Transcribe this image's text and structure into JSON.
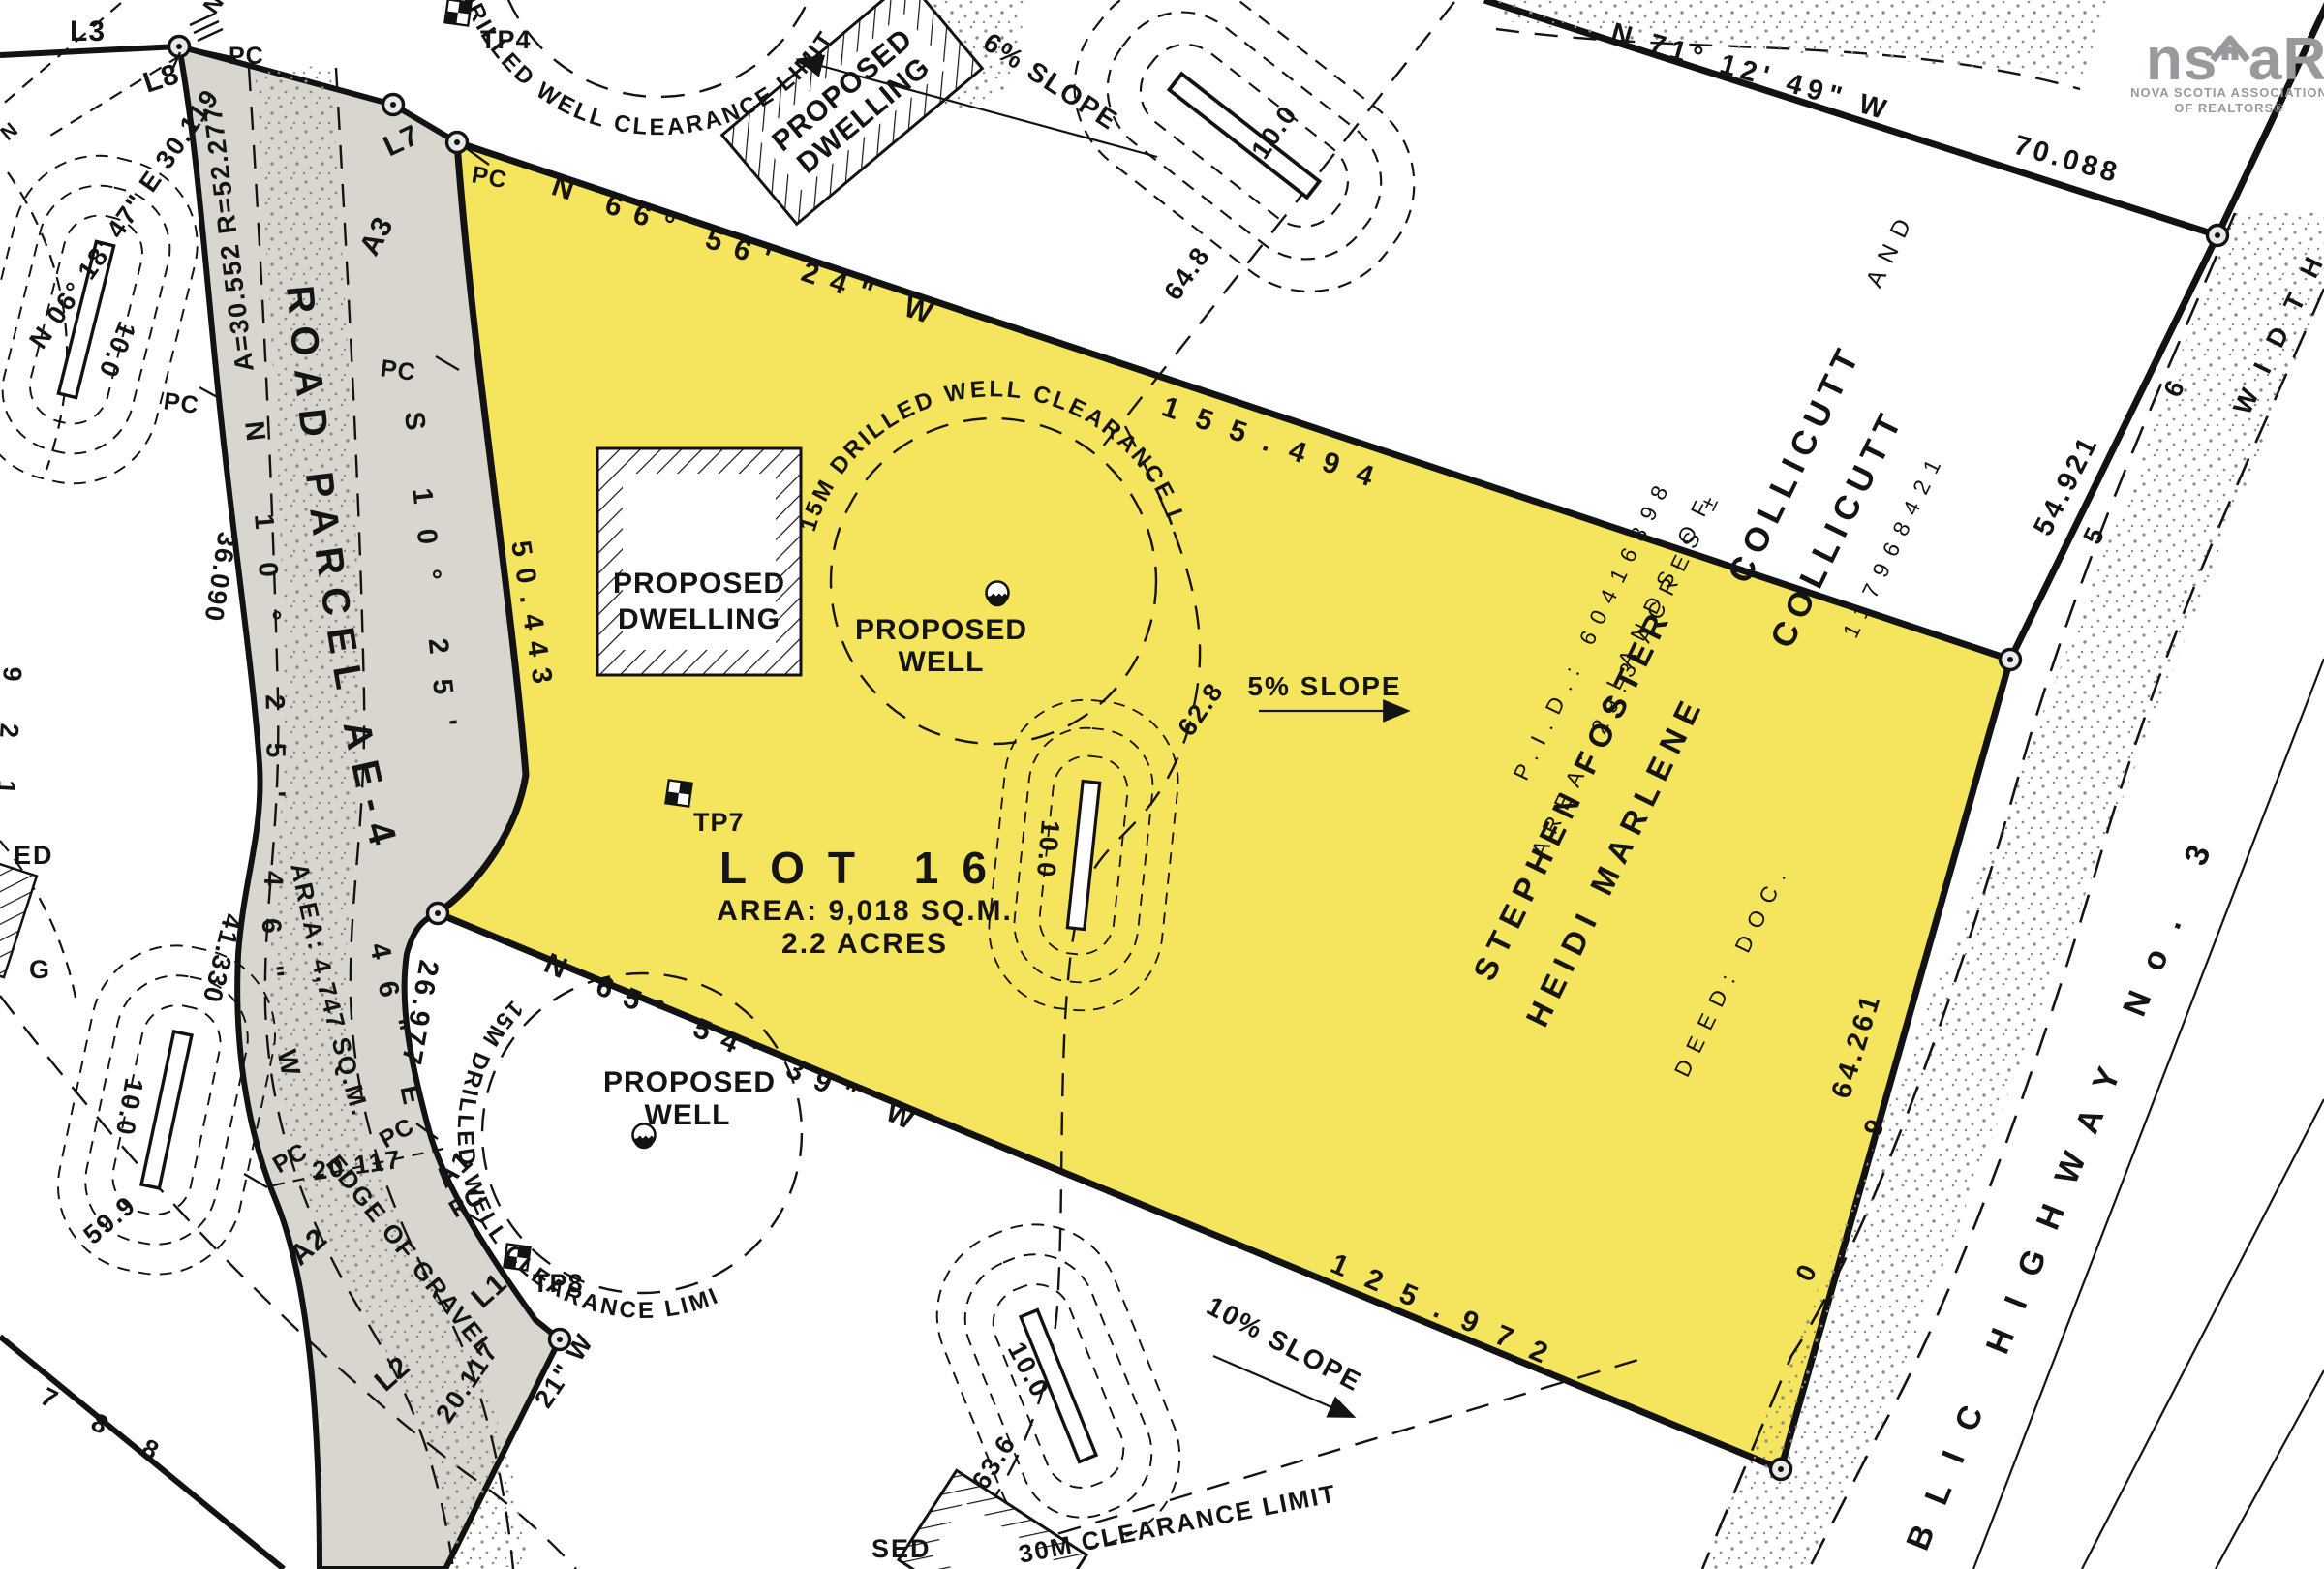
{
  "colors": {
    "lot_fill": "#F4E45E",
    "road_fill": "#D9D6CF",
    "line": "#141414",
    "logo_gray": "#97999C"
  },
  "logo": {
    "ns": "ns",
    "ar": "aR",
    "assoc": "NOVA SCOTIA ASSOCIATION",
    "realtors": "OF REALTORS®"
  },
  "lot16": {
    "name": "LOT 16",
    "area": "AREA: 9,018 SQ.M.",
    "acres": "2.2 ACRES"
  },
  "road": {
    "name": "ROAD PARCEL AE-4",
    "area": "AREA: 4,747 SQ.M.",
    "edge_of_gravel": "EDGE OF GRAVEL",
    "centerline_bearing": "N 10° 25' 46\" W",
    "curve": "A=30.552 R=52.277",
    "cross_width": "20.117"
  },
  "segments": {
    "l1": "L1",
    "l2": "L2",
    "l3": "L3",
    "l7": "L7",
    "l8": "L8",
    "a1": "A1",
    "a2": "A2",
    "a3": "A3",
    "pc": "PC"
  },
  "bearings": {
    "north": "N 66° 56' 24\" W",
    "north_d": "155.494",
    "south": "N 65° 54' 39\" W",
    "south_d": "125.972",
    "northeast": "N 71° 12' 49\" W",
    "northeast_d": "70.088",
    "highway_upper_d": "54.921",
    "highway_lower_d": "64.261",
    "west_upper": "S 10° 25'",
    "west_lower": "46\" E",
    "west_d": "50.443",
    "west_lower_d": "26.977",
    "nw": "N 06° 18' 47\" E 30.119",
    "bottom_d": "20.117",
    "bottom_frag": "21\" W"
  },
  "owner": {
    "pid": "P.I.D.: 60416898",
    "area": "AREA: 29.3 ACRES ±",
    "lands": "LANDS OF",
    "name1": "STEPHEN FOSTER",
    "name2": "HEIDI MARLENE",
    "surname": "COLLICUTT",
    "conj": "AND",
    "deed": "DEED: DOC.",
    "deed_no": "117968421"
  },
  "features": {
    "proposed": "PROPOSED",
    "dwelling": "DWELLING",
    "well": "WELL",
    "clearance15": "15M DRILLED WELL CLEARANCE LIMIT",
    "clearance30": "30M CLEARANCE LIMIT"
  },
  "fragments": {
    "sed": "SED",
    "ed": "ED",
    "g": "G",
    "n": "N"
  },
  "testpits": {
    "tp4": "TP4",
    "tp7": "TP7",
    "tp8": "TP8"
  },
  "slopes": {
    "s6": "6% SLOPE",
    "s5": "5% SLOPE",
    "s10": "10% SLOPE"
  },
  "dims": {
    "ten": "10.0",
    "d648": "64.8",
    "d628": "62.8",
    "d636": "63.6",
    "d36": "36.090",
    "d41": "41.330",
    "d59": "59.9",
    "d788": "7 8 8",
    "d921": "9 2 1"
  },
  "highway": {
    "name": "PUBLIC HIGHWAY No. 3",
    "width": "WIDTH",
    "d6": "6",
    "d5": "5",
    "d9": "9",
    "d0": "0"
  }
}
